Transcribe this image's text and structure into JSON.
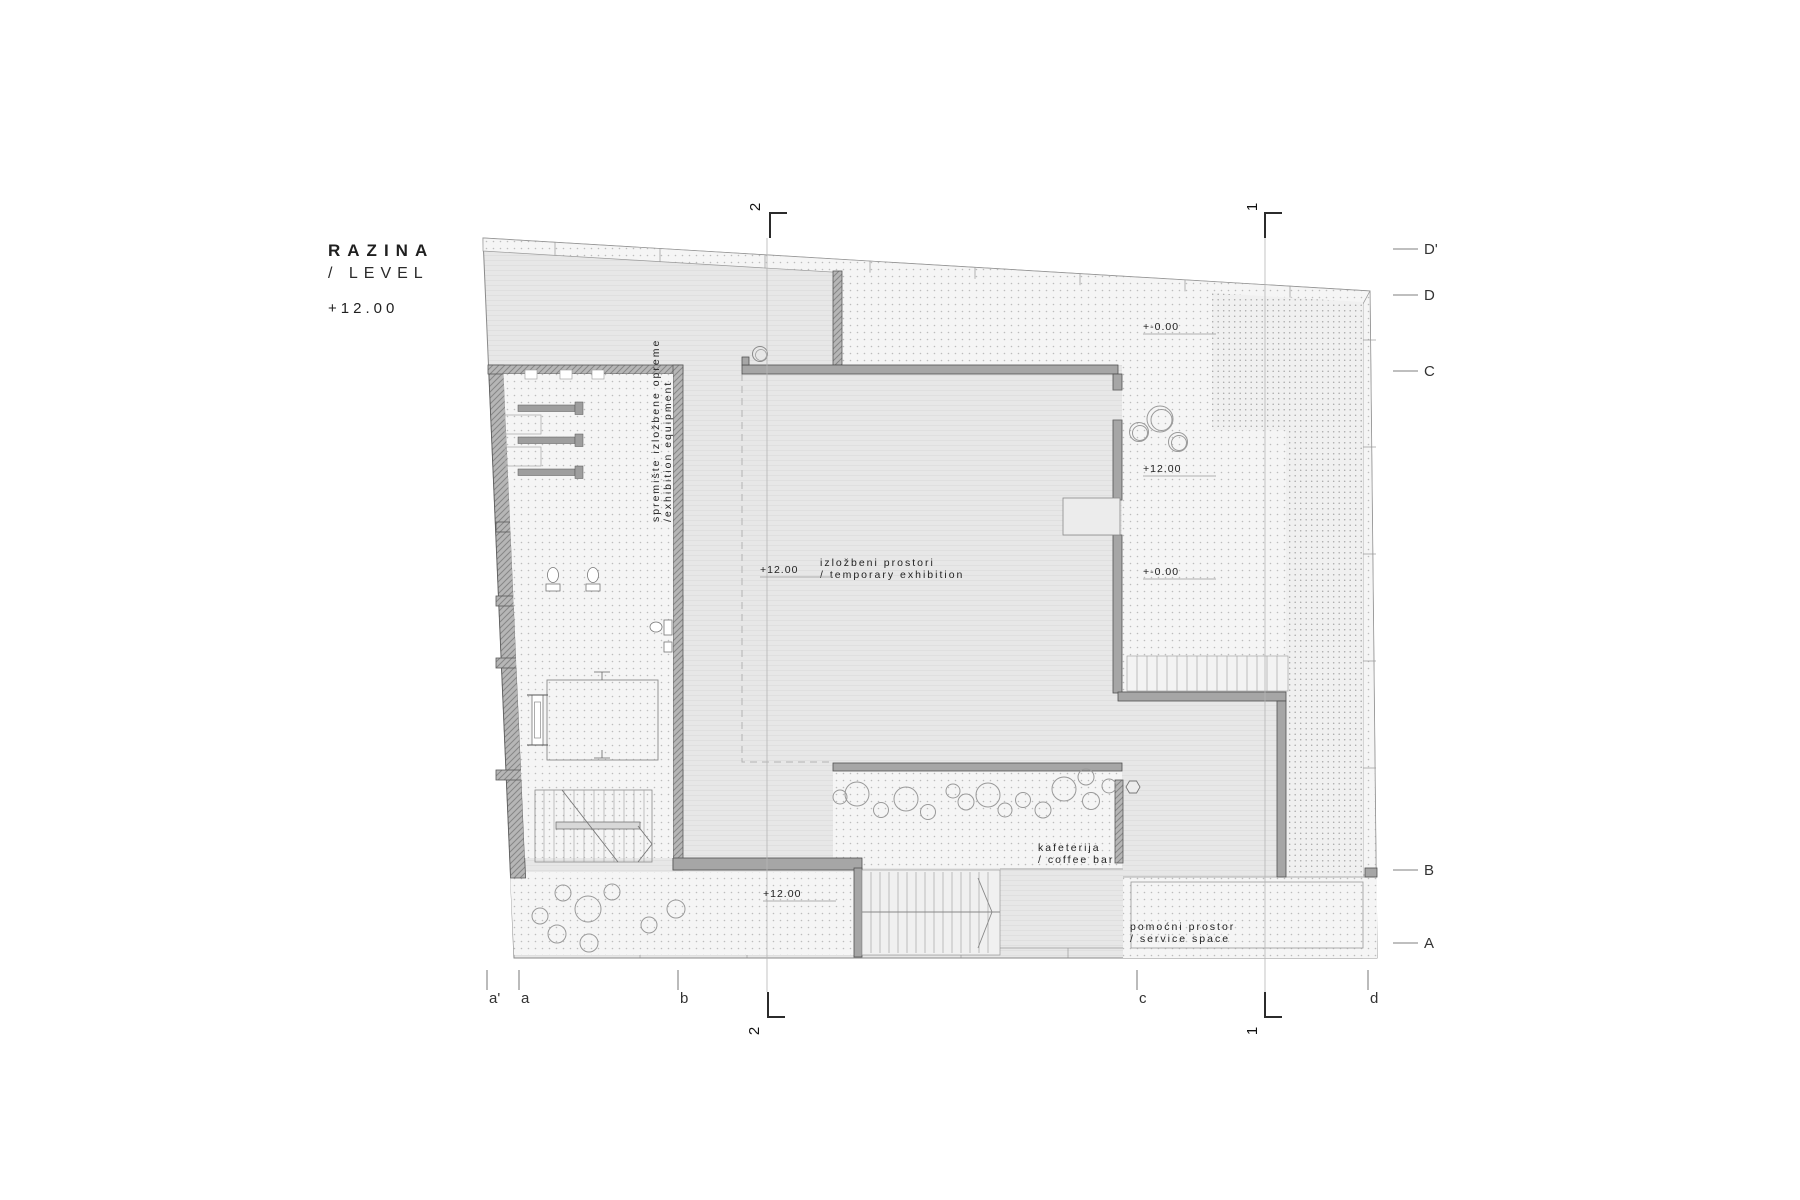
{
  "title": {
    "line1": "RAZINA",
    "line2": "/ LEVEL",
    "level": "+12.00"
  },
  "labels": {
    "storage": {
      "line1": "spremište izložbene opreme",
      "line2": "/exhibition equipment"
    },
    "exhibition": {
      "line1": "izložbeni prostori",
      "line2": "/ temporary exhibition"
    },
    "cafe": {
      "line1": "kafeterija",
      "line2": "/ coffee bar"
    },
    "service": {
      "line1": "pomoćni prostor",
      "line2": "/ service space"
    }
  },
  "levels": {
    "upper_terrace": "+-0.00",
    "right_terrace": "+12.00",
    "lower_right": "+-0.00",
    "hall": "+12.00",
    "south_terrace": "+12.00"
  },
  "grid": {
    "right": [
      "D'",
      "D",
      "C",
      "B",
      "A"
    ],
    "bottom": [
      "a'",
      "a",
      "b",
      "c",
      "d"
    ]
  },
  "sections": {
    "s1": "1",
    "s2": "2"
  },
  "colors": {
    "wall": "#a6a6a6",
    "floor": "#e7e7e7",
    "terrace": "#f5f5f5",
    "ink": "#1f1f1f"
  }
}
